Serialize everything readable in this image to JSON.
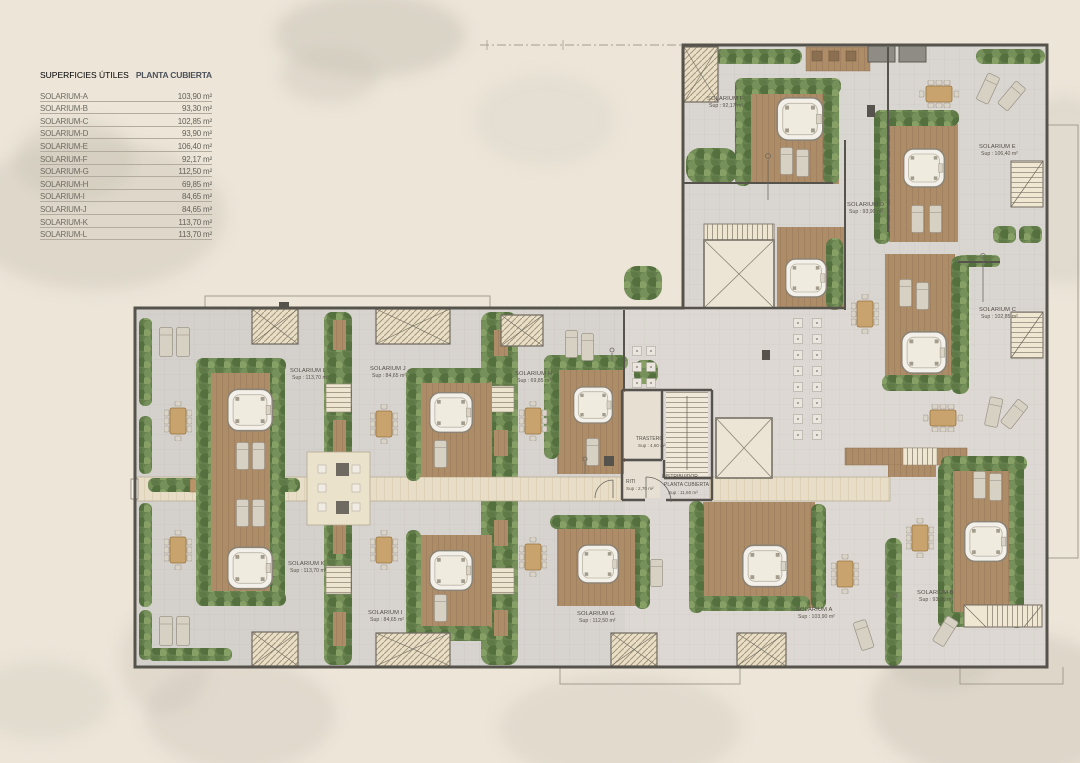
{
  "legend": {
    "title_left": "SUPERFICIES ÚTILES",
    "title_right": "PLANTA CUBIERTA",
    "rows": [
      {
        "label": "SOLARIUM-A",
        "value": "103,90 m²"
      },
      {
        "label": "SOLARIUM-B",
        "value": "93,30 m²"
      },
      {
        "label": "SOLARIUM-C",
        "value": "102,85 m²"
      },
      {
        "label": "SOLARIUM-D",
        "value": "93,90 m²"
      },
      {
        "label": "SOLARIUM-E",
        "value": "106,40 m²"
      },
      {
        "label": "SOLARIUM-F",
        "value": "92,17 m²"
      },
      {
        "label": "SOLARIUM-G",
        "value": "112,50 m²"
      },
      {
        "label": "SOLARIUM-H",
        "value": "69,85 m²"
      },
      {
        "label": "SOLARIUM-I",
        "value": "84,65 m²"
      },
      {
        "label": "SOLARIUM-J",
        "value": "84,65 m²"
      },
      {
        "label": "SOLARIUM-K",
        "value": "113,70 m²"
      },
      {
        "label": "SOLARIUM-L",
        "value": "113,70 m²"
      }
    ]
  },
  "plan": {
    "rooms": [
      {
        "id": "F",
        "name": "SOLARIUM F",
        "sup": "Sup : 92,17 m²"
      },
      {
        "id": "E",
        "name": "SOLARIUM E",
        "sup": "Sup : 106,40 m²"
      },
      {
        "id": "D",
        "name": "SOLARIUM D",
        "sup": "Sup : 93,90 m²"
      },
      {
        "id": "C",
        "name": "SOLARIUM C",
        "sup": "Sup : 102,85 m²"
      },
      {
        "id": "L",
        "name": "SOLARIUM L",
        "sup": "Sup : 113,70 m²"
      },
      {
        "id": "J",
        "name": "SOLARIUM J",
        "sup": "Sup : 84,65 m²"
      },
      {
        "id": "H",
        "name": "SOLARIUM H",
        "sup": "Sup : 69,85 m²"
      },
      {
        "id": "K",
        "name": "SOLARIUM K",
        "sup": "Sup : 113,70 m²"
      },
      {
        "id": "I",
        "name": "SOLARIUM I",
        "sup": "Sup : 84,65 m²"
      },
      {
        "id": "G",
        "name": "SOLARIUM G",
        "sup": "Sup : 112,50 m²"
      },
      {
        "id": "A",
        "name": "SOLARIUM A",
        "sup": "Sup : 103,90 m²"
      },
      {
        "id": "B",
        "name": "SOLARIUM B",
        "sup": "Sup : 93,30 m²"
      }
    ],
    "core": {
      "trastero_name": "TRASTERO",
      "trastero_sup": "Sup : 4,50 m²",
      "riti_name": "RITI",
      "riti_sup": "Sup : 2,70 m²",
      "distribuidor_name": "DISTRIBUIDOR",
      "distribuidor_sub": "PLANTA CUBIERTA",
      "distribuidor_sup": "Sup : 11,60 m²"
    },
    "colors": {
      "background": "#ece5d8",
      "paving": "#d7d3cf",
      "deck_wood": "#ad8c68",
      "hedge_green": "#66804e",
      "walkway": "#e8ddc7",
      "wall": "#56524c",
      "jacuzzi": "#f3f0e9",
      "label_text": "#544f47",
      "legend_header_accent": "#4d525b"
    }
  }
}
